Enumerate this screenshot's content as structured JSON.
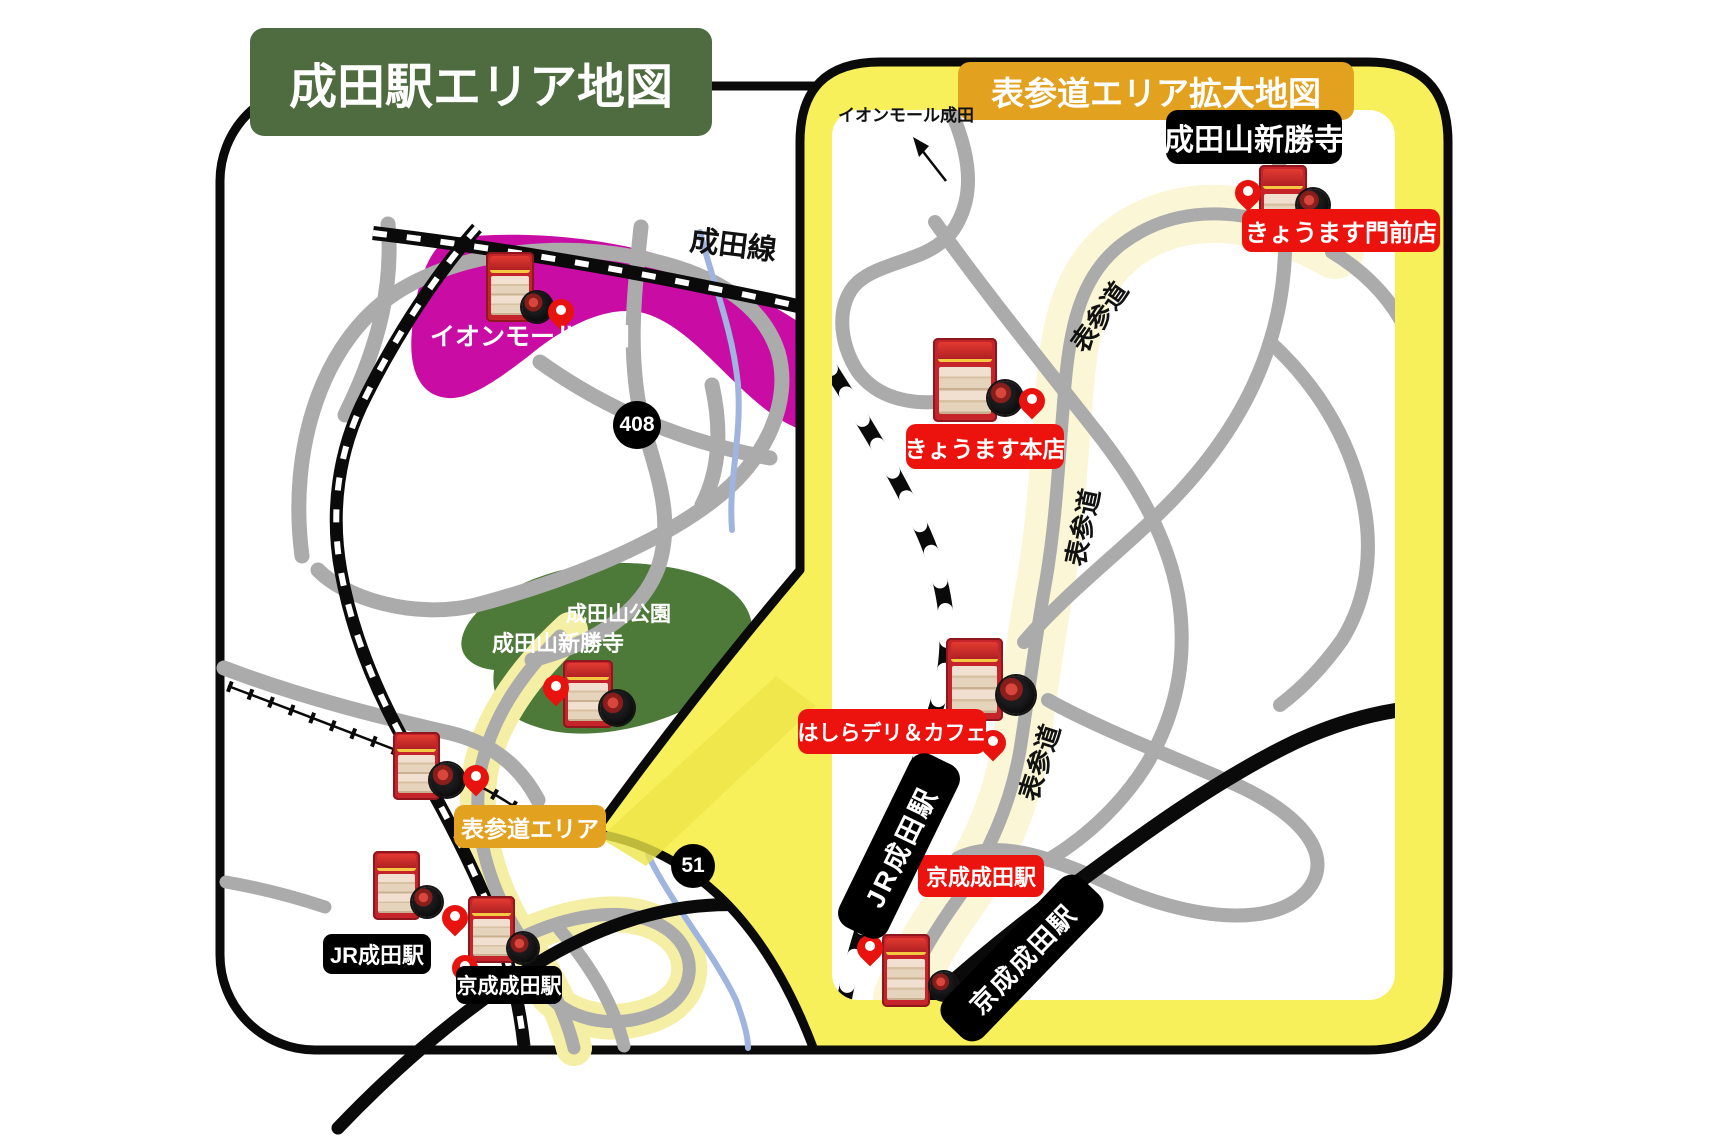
{
  "left_map": {
    "title": "成田駅エリア地図",
    "rail_line_label": "成田線",
    "aeon_mall_label": "イオンモール成田",
    "park_label": "成田山公園",
    "temple_label": "成田山新勝寺",
    "area_tag_label": "表参道エリア",
    "route_badge_408": "408",
    "route_badge_51": "51",
    "jr_station_label": "JR成田駅",
    "keisei_station_label": "京成成田駅"
  },
  "right_map": {
    "title": "表参道エリア拡大地図",
    "aeon_direction_label": "イオンモール成田",
    "temple_label": "成田山新勝寺",
    "shop_monzen_label": "きょうます門前店",
    "shop_honten_label": "きょうます本店",
    "shop_hashira_label": "はしらデリ＆カフェ",
    "keisei_station_red_label": "京成成田駅",
    "jr_station_label": "JR成田駅",
    "keisei_station_label": "京成成田駅",
    "street_label": "表参道"
  },
  "colors": {
    "title_green": "#4F6B40",
    "park_green": "#4E7A39",
    "orange": "#E2A11E",
    "magenta": "#C90CA4",
    "label_red": "#EC130E",
    "pin_red": "#E8130F",
    "bubble_yellow": "#F7F05A",
    "bubble_yellow_shade": "#ECE549",
    "pale_yellow_left": "#F5EFA5",
    "pale_yellow_right": "#FAF6D6",
    "road_gray": "#ABABAB",
    "river_blue": "#9FB4DE",
    "rail_black": "#0A0A0A"
  }
}
